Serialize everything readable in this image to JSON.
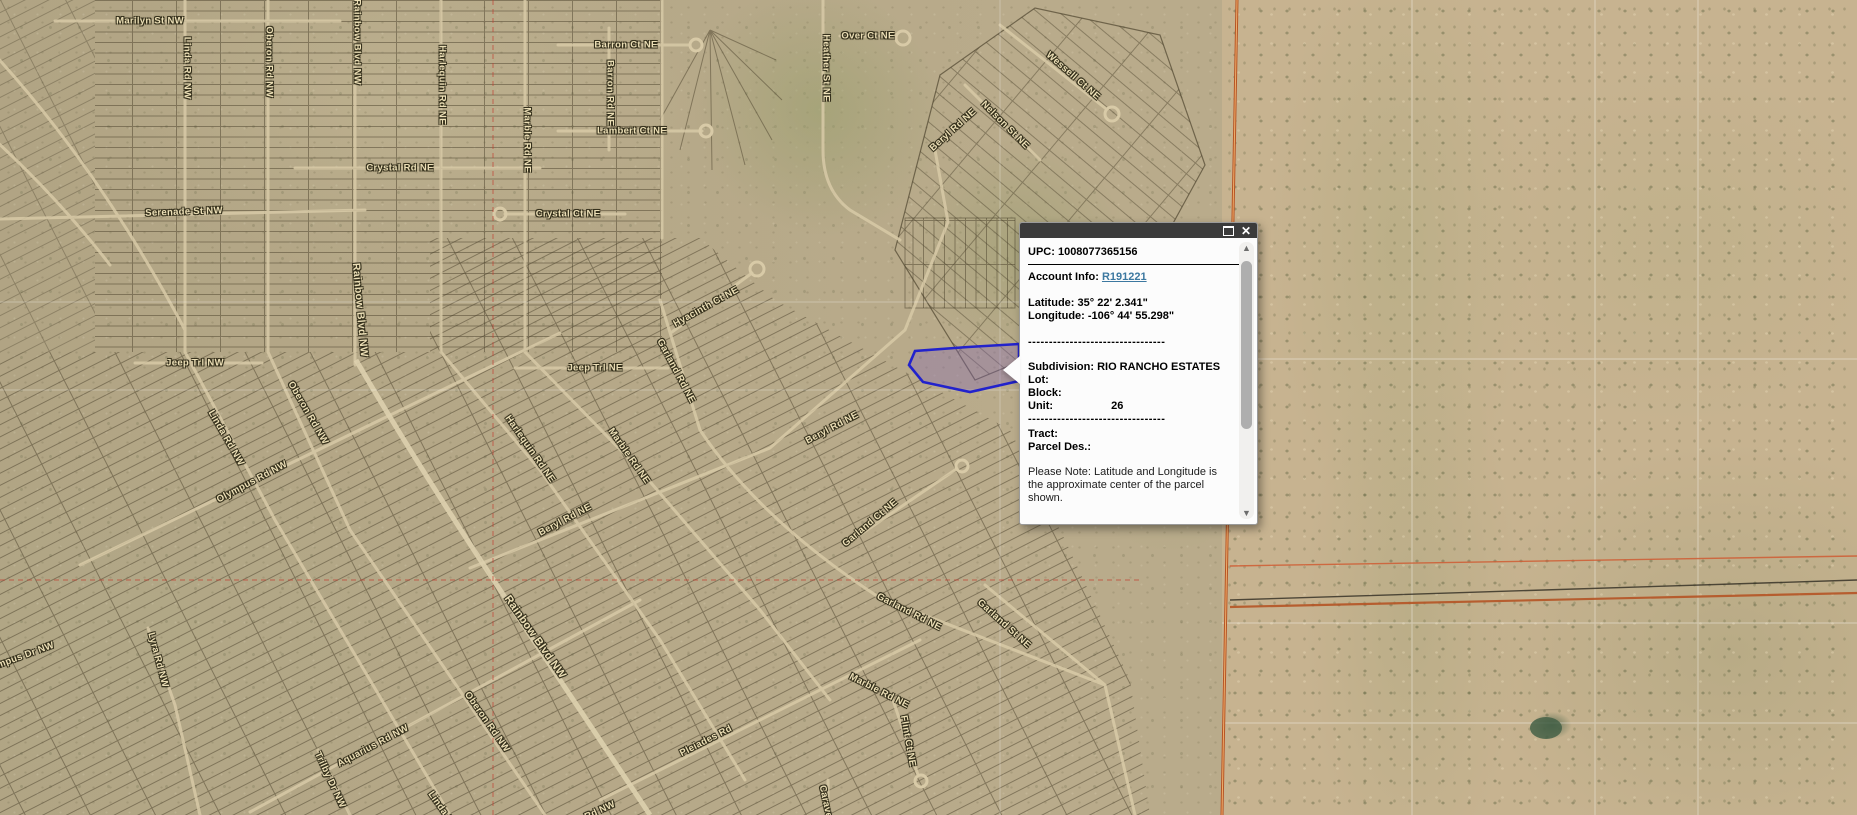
{
  "app": {
    "name": "parcel-map-viewer",
    "view": "aerial-imagery-with-parcels"
  },
  "popup": {
    "upc_label": "UPC:",
    "upc_value": "1008077365156",
    "account_label": "Account Info:",
    "account_link": "R191221",
    "latitude_label": "Latitude:",
    "latitude_value": "35° 22' 2.341\"",
    "longitude_label": "Longitude:",
    "longitude_value": "-106° 44' 55.298\"",
    "separator": "---------------------------------",
    "subdivision_label": "Subdivision:",
    "subdivision_value": "RIO RANCHO ESTATES",
    "lot_label": "Lot:",
    "lot_value": "",
    "block_label": "Block:",
    "block_value": "",
    "unit_label": "Unit:",
    "unit_value": "26",
    "tract_label": "Tract:",
    "tract_value": "",
    "parcel_des_label": "Parcel Des.:",
    "parcel_des_value": "",
    "note": "Please Note: Latitude and Longitude is the approximate center of the parcel shown.",
    "icons": {
      "maximize": "restore-window-square",
      "close": "✕",
      "scroll_up": "▲",
      "scroll_down": "▼"
    }
  },
  "map": {
    "selected_parcel": {
      "subdivision": "RIO RANCHO ESTATES",
      "unit": "26",
      "highlighted": true
    },
    "colors": {
      "selected_parcel_stroke": "#2222cc",
      "selected_parcel_fill": "rgba(130,100,180,0.35)",
      "boundary_orange": "#b55425",
      "boundary_orange_light": "#efae6b",
      "section_line_red": "#c23b2e",
      "street_label": "#ecdfb6",
      "popup_header": "#3b3b3b",
      "account_link": "#3c78a0"
    },
    "street_labels": [
      {
        "t": "Marilyn St NW",
        "x": 150,
        "y": 21,
        "r": 0
      },
      {
        "t": "Linda Rd NW",
        "x": 187,
        "y": 68,
        "r": 90
      },
      {
        "t": "Oberon Rd NW",
        "x": 269,
        "y": 62,
        "r": 90
      },
      {
        "t": "Rainbow Blvd NW",
        "x": 357,
        "y": 42,
        "r": 90
      },
      {
        "t": "Harlequin Rd NE",
        "x": 442,
        "y": 85,
        "r": 90
      },
      {
        "t": "Marble Rd NE",
        "x": 527,
        "y": 140,
        "r": 90
      },
      {
        "t": "Barron Ct NE",
        "x": 626,
        "y": 45,
        "r": 0
      },
      {
        "t": "Barron Rd NE",
        "x": 610,
        "y": 93,
        "r": 90
      },
      {
        "t": "Lambert Ct NE",
        "x": 632,
        "y": 131,
        "r": 0
      },
      {
        "t": "Heather St NE",
        "x": 826,
        "y": 68,
        "r": 90
      },
      {
        "t": "Over Ct NE",
        "x": 868,
        "y": 36,
        "r": 0
      },
      {
        "t": "Wessell Ct NE",
        "x": 1073,
        "y": 76,
        "r": 41
      },
      {
        "t": "Beryl Rd NE",
        "x": 953,
        "y": 130,
        "r": -42
      },
      {
        "t": "Nelson St NE",
        "x": 1005,
        "y": 125,
        "r": 45
      },
      {
        "t": "Crystal Rd NE",
        "x": 400,
        "y": 168,
        "r": 0
      },
      {
        "t": "Serenade St NW",
        "x": 184,
        "y": 212,
        "r": -2
      },
      {
        "t": "Crystal Ct NE",
        "x": 568,
        "y": 214,
        "r": 0
      },
      {
        "t": "Hyacinth Ct NE",
        "x": 706,
        "y": 307,
        "r": -29
      },
      {
        "t": "Jeep Trl NW",
        "x": 195,
        "y": 363,
        "r": 0
      },
      {
        "t": "Jeep Trl NE",
        "x": 595,
        "y": 368,
        "r": 0
      },
      {
        "t": "Garland Rd NE",
        "x": 676,
        "y": 371,
        "r": 62
      },
      {
        "t": "Linda Rd NW",
        "x": 226,
        "y": 438,
        "r": 60
      },
      {
        "t": "Oberon Rd NW",
        "x": 308,
        "y": 413,
        "r": 60
      },
      {
        "t": "Rainbow Blvd NW",
        "x": 360,
        "y": 310,
        "r": 85,
        "s": 10.5
      },
      {
        "t": "Harlequin Rd NE",
        "x": 530,
        "y": 449,
        "r": 55
      },
      {
        "t": "Marble Rd NE",
        "x": 629,
        "y": 456,
        "r": 55
      },
      {
        "t": "Beryl Rd NE",
        "x": 832,
        "y": 428,
        "r": -28
      },
      {
        "t": "Beryl Rd NE",
        "x": 565,
        "y": 520,
        "r": -28
      },
      {
        "t": "Olympus Rd NW",
        "x": 252,
        "y": 482,
        "r": -28
      },
      {
        "t": "Rainbow Blvd NW",
        "x": 535,
        "y": 637,
        "r": 55,
        "s": 11
      },
      {
        "t": "Garland Ct NE",
        "x": 870,
        "y": 523,
        "r": -40
      },
      {
        "t": "Garland Rd NE",
        "x": 909,
        "y": 612,
        "r": 27
      },
      {
        "t": "Garland St NE",
        "x": 1004,
        "y": 624,
        "r": 42
      },
      {
        "t": "Oberon Rd NW",
        "x": 487,
        "y": 722,
        "r": 55
      },
      {
        "t": "Lyra Rd NW",
        "x": 158,
        "y": 660,
        "r": 75
      },
      {
        "t": "Olympus Dr NW",
        "x": 18,
        "y": 658,
        "r": -20
      },
      {
        "t": "Aquarius Rd NW",
        "x": 373,
        "y": 746,
        "r": -28
      },
      {
        "t": "Trilby Dr NW",
        "x": 330,
        "y": 780,
        "r": 65
      },
      {
        "t": "Pleiades Rd",
        "x": 706,
        "y": 741,
        "r": -27
      },
      {
        "t": "Marble Rd NE",
        "x": 879,
        "y": 691,
        "r": 27
      },
      {
        "t": "Flint Ct NE",
        "x": 908,
        "y": 741,
        "r": 80
      },
      {
        "t": "Linda Rd NW",
        "x": 448,
        "y": 818,
        "r": 55
      },
      {
        "t": "Pegasus Rd NW",
        "x": 580,
        "y": 820,
        "r": -25
      },
      {
        "t": "Caravel Ct NE",
        "x": 829,
        "y": 818,
        "r": 78
      }
    ]
  }
}
